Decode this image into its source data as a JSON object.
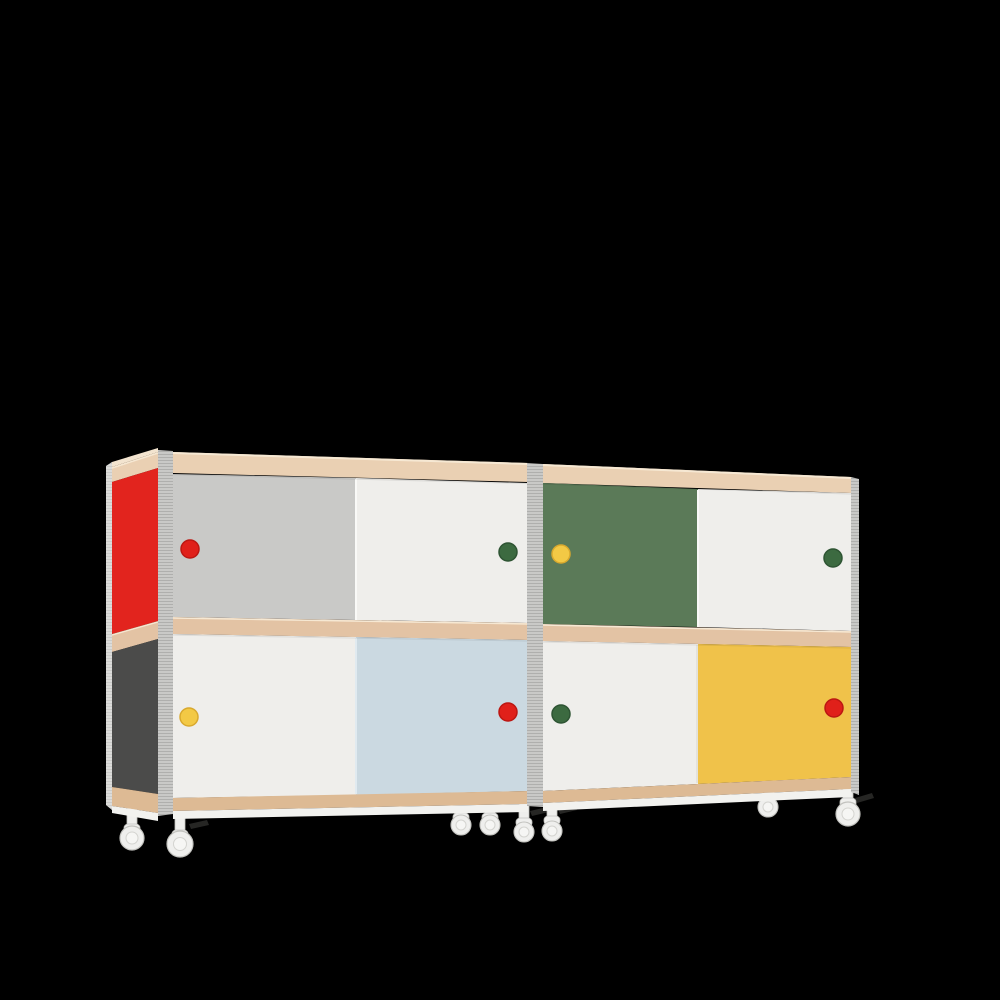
{
  "scene": {
    "background_color": "#000000",
    "object": "sideboard-with-sliding-doors-on-casters",
    "units_count": 2,
    "casters_visible": 8
  },
  "colors": {
    "background": "#000000",
    "red": "#e2241e",
    "dark_gray": "#4b4b4a",
    "door_gray": "#c9c9c7",
    "door_white": "#efeeeb",
    "door_green": "#5b7a58",
    "door_blue": "#cbd9e1",
    "door_yellow": "#f0c24a",
    "handle_red": "#e0201a",
    "rim_red": "#bc1712",
    "handle_green": "#3c6a40",
    "rim_green": "#2e5433",
    "handle_yellow": "#f3c945",
    "rim_yellow": "#d9a92e",
    "wood_top": "#ead0b3",
    "wood_mid": "#e3c3a4",
    "wood_rail": "#ddba94",
    "wood_highlight": "#f6e8d3",
    "top_face": "#f3e4cf",
    "edge_base": "#c9c9c7",
    "edge_line": "#a9a9a7",
    "plinth": "#f2f2ef",
    "white_edge": "#f9f9f7",
    "blue_edge": "#e0eaf0",
    "shadow_edge": "#dfddd8",
    "caster_body": "#efefed",
    "caster_edge": "#c2c2be",
    "caster_hub": "#f6f6f4",
    "caster_hub_edge": "#d4d4d0",
    "brake": "#262624"
  },
  "cabinet": {
    "left_unit": {
      "side_panel_top": "red",
      "side_panel_bottom": "dark-gray",
      "doors": {
        "top_left": {
          "color": "gray",
          "handle": "red"
        },
        "top_right": {
          "color": "white",
          "handle": "green"
        },
        "bottom_left": {
          "color": "white",
          "handle": "yellow"
        },
        "bottom_right": {
          "color": "light-blue",
          "handle": "red"
        }
      }
    },
    "right_unit": {
      "doors": {
        "top_left": {
          "color": "green",
          "handle": "yellow"
        },
        "top_right": {
          "color": "white",
          "handle": "green"
        },
        "bottom_left": {
          "color": "white",
          "handle": "green"
        },
        "bottom_right": {
          "color": "yellow",
          "handle": "red"
        }
      }
    }
  }
}
